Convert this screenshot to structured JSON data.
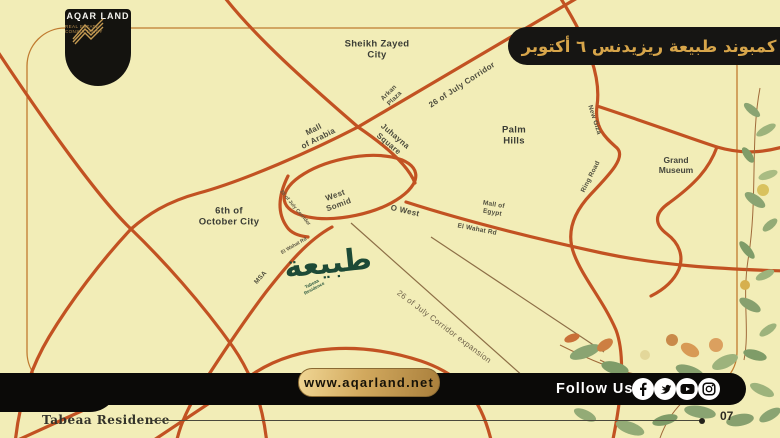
{
  "page": {
    "colors": {
      "background": "#f2edb7",
      "road_orange": "#c25222",
      "frame_line": "#c07b30",
      "gold": "#d7a54a",
      "banner_black": "#161513",
      "project_green": "#1d4a36"
    }
  },
  "logo": {
    "brand": "AQAR LAND",
    "tagline": "REAL ESTATE CONSULTANCY",
    "icon": "gold-wings"
  },
  "banner": {
    "title_ar": "كمبوند طبيعة ريزيدنس ٦ أكتوبر"
  },
  "project": {
    "name_ar": "طبيعة",
    "name_en": "Tabeaa\nResidence"
  },
  "map": {
    "labels": [
      {
        "id": "sheikh-zayed-city",
        "text": "Sheikh Zayed\nCity",
        "cls": "city",
        "x": 377,
        "y": 50,
        "rot": 0
      },
      {
        "id": "arkan-plaza",
        "text": "Arkan\nPlaza",
        "cls": "small",
        "x": 392,
        "y": 96,
        "rot": -45
      },
      {
        "id": "26-july-corridor",
        "text": "26 of July Corridor",
        "cls": "road",
        "x": 462,
        "y": 85,
        "rot": -33
      },
      {
        "id": "mall-of-arabia",
        "text": "Mall\nof Arabia",
        "cls": "road",
        "x": 316,
        "y": 134,
        "rot": -27
      },
      {
        "id": "juhayna-square",
        "text": "Juhayna\nSquare",
        "cls": "road",
        "x": 392,
        "y": 140,
        "rot": 40
      },
      {
        "id": "palm-hills",
        "text": "Palm\nHills",
        "cls": "city",
        "x": 514,
        "y": 136,
        "rot": 0
      },
      {
        "id": "new-giza",
        "text": "New Giza",
        "cls": "small",
        "x": 594,
        "y": 120,
        "rot": 72
      },
      {
        "id": "ring-road",
        "text": "Ring Road",
        "cls": "small",
        "x": 591,
        "y": 177,
        "rot": -63
      },
      {
        "id": "grand-museum",
        "text": "Grand\nMuseum",
        "cls": "landmark",
        "x": 676,
        "y": 165,
        "rot": 0
      },
      {
        "id": "west-somid",
        "text": "West\nSomid",
        "cls": "road",
        "x": 337,
        "y": 200,
        "rot": -20
      },
      {
        "id": "o-west",
        "text": "O West",
        "cls": "road",
        "x": 405,
        "y": 211,
        "rot": 13
      },
      {
        "id": "mall-of-egypt",
        "text": "Mall of\nEgypt",
        "cls": "small",
        "x": 493,
        "y": 209,
        "rot": 10
      },
      {
        "id": "el-wahat-rd",
        "text": "El Wahat Rd",
        "cls": "small",
        "x": 477,
        "y": 230,
        "rot": 11
      },
      {
        "id": "6th-october-city",
        "text": "6th of\nOctober City",
        "cls": "city",
        "x": 229,
        "y": 217,
        "rot": 0
      },
      {
        "id": "26-july-corridor-small",
        "text": "26 of July Corridor",
        "cls": "tiny",
        "x": 295,
        "y": 208,
        "rot": 50
      },
      {
        "id": "el-wahat-rd-small",
        "text": "El Wahat Rd",
        "cls": "tiny",
        "x": 294,
        "y": 246,
        "rot": -30
      },
      {
        "id": "msa",
        "text": "MSA",
        "cls": "small",
        "x": 261,
        "y": 278,
        "rot": -48
      },
      {
        "id": "26-july-corridor-expansion",
        "text": "26 of July Corridor expansion",
        "cls": "thin",
        "x": 444,
        "y": 327,
        "rot": 37
      }
    ]
  },
  "footer": {
    "website": "www.aqarland.net",
    "follow_label": "Follow Us",
    "social": [
      "facebook",
      "twitter",
      "youtube",
      "instagram"
    ],
    "page_label": "Tabeaa Residence",
    "page_number": "07"
  }
}
